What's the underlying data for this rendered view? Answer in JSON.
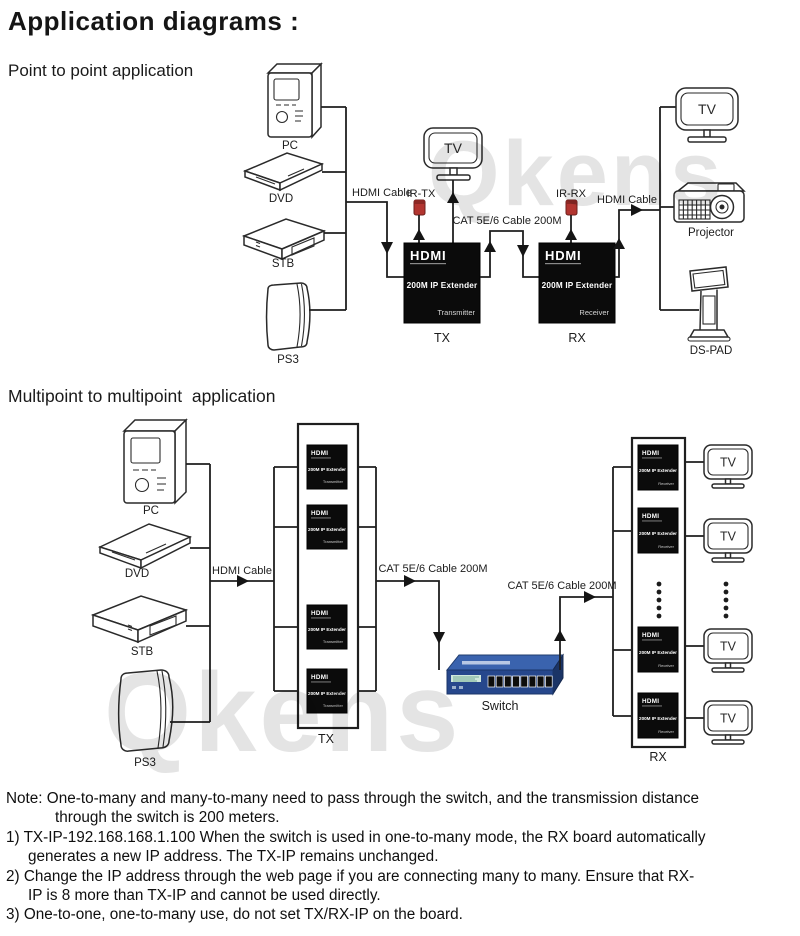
{
  "page": {
    "title": "Application diagrams :",
    "watermark": "Qkens"
  },
  "p2p": {
    "heading": "Point to point application",
    "source_labels": [
      "PC",
      "DVD",
      "STB",
      "PS3"
    ],
    "hdmi_cable_left": "HDMI Cable",
    "hdmi_cable_right": "HDMI Cable",
    "ir_tx": "IR-TX",
    "ir_rx": "IR-RX",
    "cat_cable": "CAT 5E/6 Cable 200M",
    "tv_top": "TV",
    "tx": {
      "brand": "HDMI",
      "model": "200M IP Extender",
      "role": "Transmitter",
      "tag": "TX"
    },
    "rx": {
      "brand": "HDMI",
      "model": "200M IP Extender",
      "role": "Receiver",
      "tag": "RX"
    },
    "sink_labels": {
      "tv": "TV",
      "projector": "Projector",
      "dspad": "DS-PAD"
    }
  },
  "mp": {
    "heading": "Multipoint to multipoint  application",
    "source_labels": [
      "PC",
      "DVD",
      "STB",
      "PS3"
    ],
    "hdmi_cable": "HDMI Cable",
    "cat_cable_1": "CAT 5E/6 Cable 200M",
    "cat_cable_2": "CAT 5E/6 Cable 200M",
    "switch_label": "Switch",
    "tx_tag": "TX",
    "rx_tag": "RX",
    "tv_label": "TV",
    "tx_unit": {
      "brand": "HDMI",
      "model": "200M IP Extender",
      "role": "Transmitter"
    },
    "rx_unit": {
      "brand": "HDMI",
      "model": "200M IP Extender",
      "role": "Receiver"
    }
  },
  "notes": {
    "lines": [
      "Note: One-to-many and many-to-many need to pass through the switch, and the transmission distance",
      "through the switch is 200 meters.",
      "1) TX-IP-192.168.168.1.100 When the switch is used in one-to-many mode, the RX board automatically",
      "generates a new IP address. The TX-IP remains unchanged.",
      "2) Change the IP address through the web page if you are connecting many to many. Ensure that RX-",
      "IP is 8 more than TX-IP and cannot be used directly.",
      "3) One-to-one, one-to-many use, do not set TX/RX-IP on the board."
    ]
  }
}
